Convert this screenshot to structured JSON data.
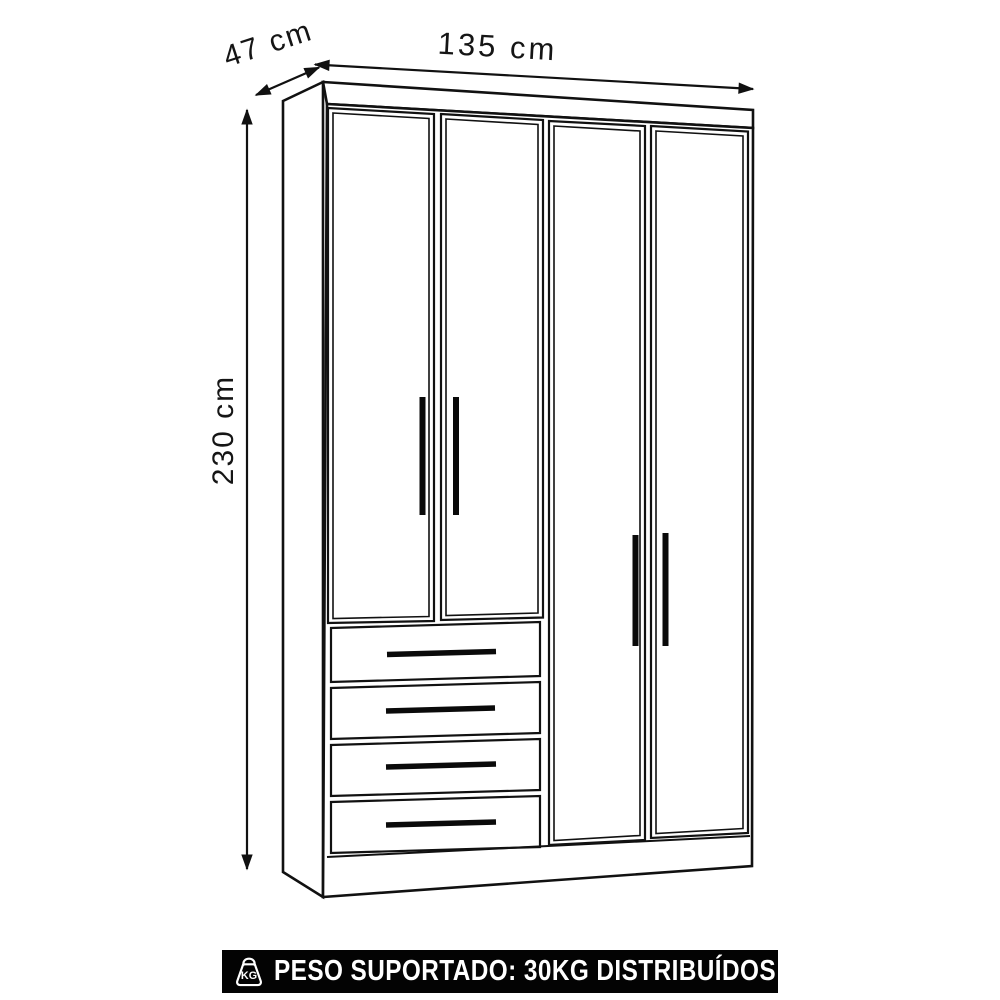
{
  "colors": {
    "background": "#ffffff",
    "line": "#111111",
    "banner_background": "#030303",
    "banner_text": "#ffffff"
  },
  "diagram": {
    "subject": "wardrobe-line-drawing",
    "dimensions": {
      "width": "135 cm",
      "depth": "47 cm",
      "height": "230 cm"
    },
    "structure": {
      "doors": 4,
      "drawers": 4
    }
  },
  "banner": {
    "icon": "kg-weight-icon",
    "icon_label": "KG",
    "text": "PESO SUPORTADO: 30KG DISTRIBUÍDOS"
  }
}
